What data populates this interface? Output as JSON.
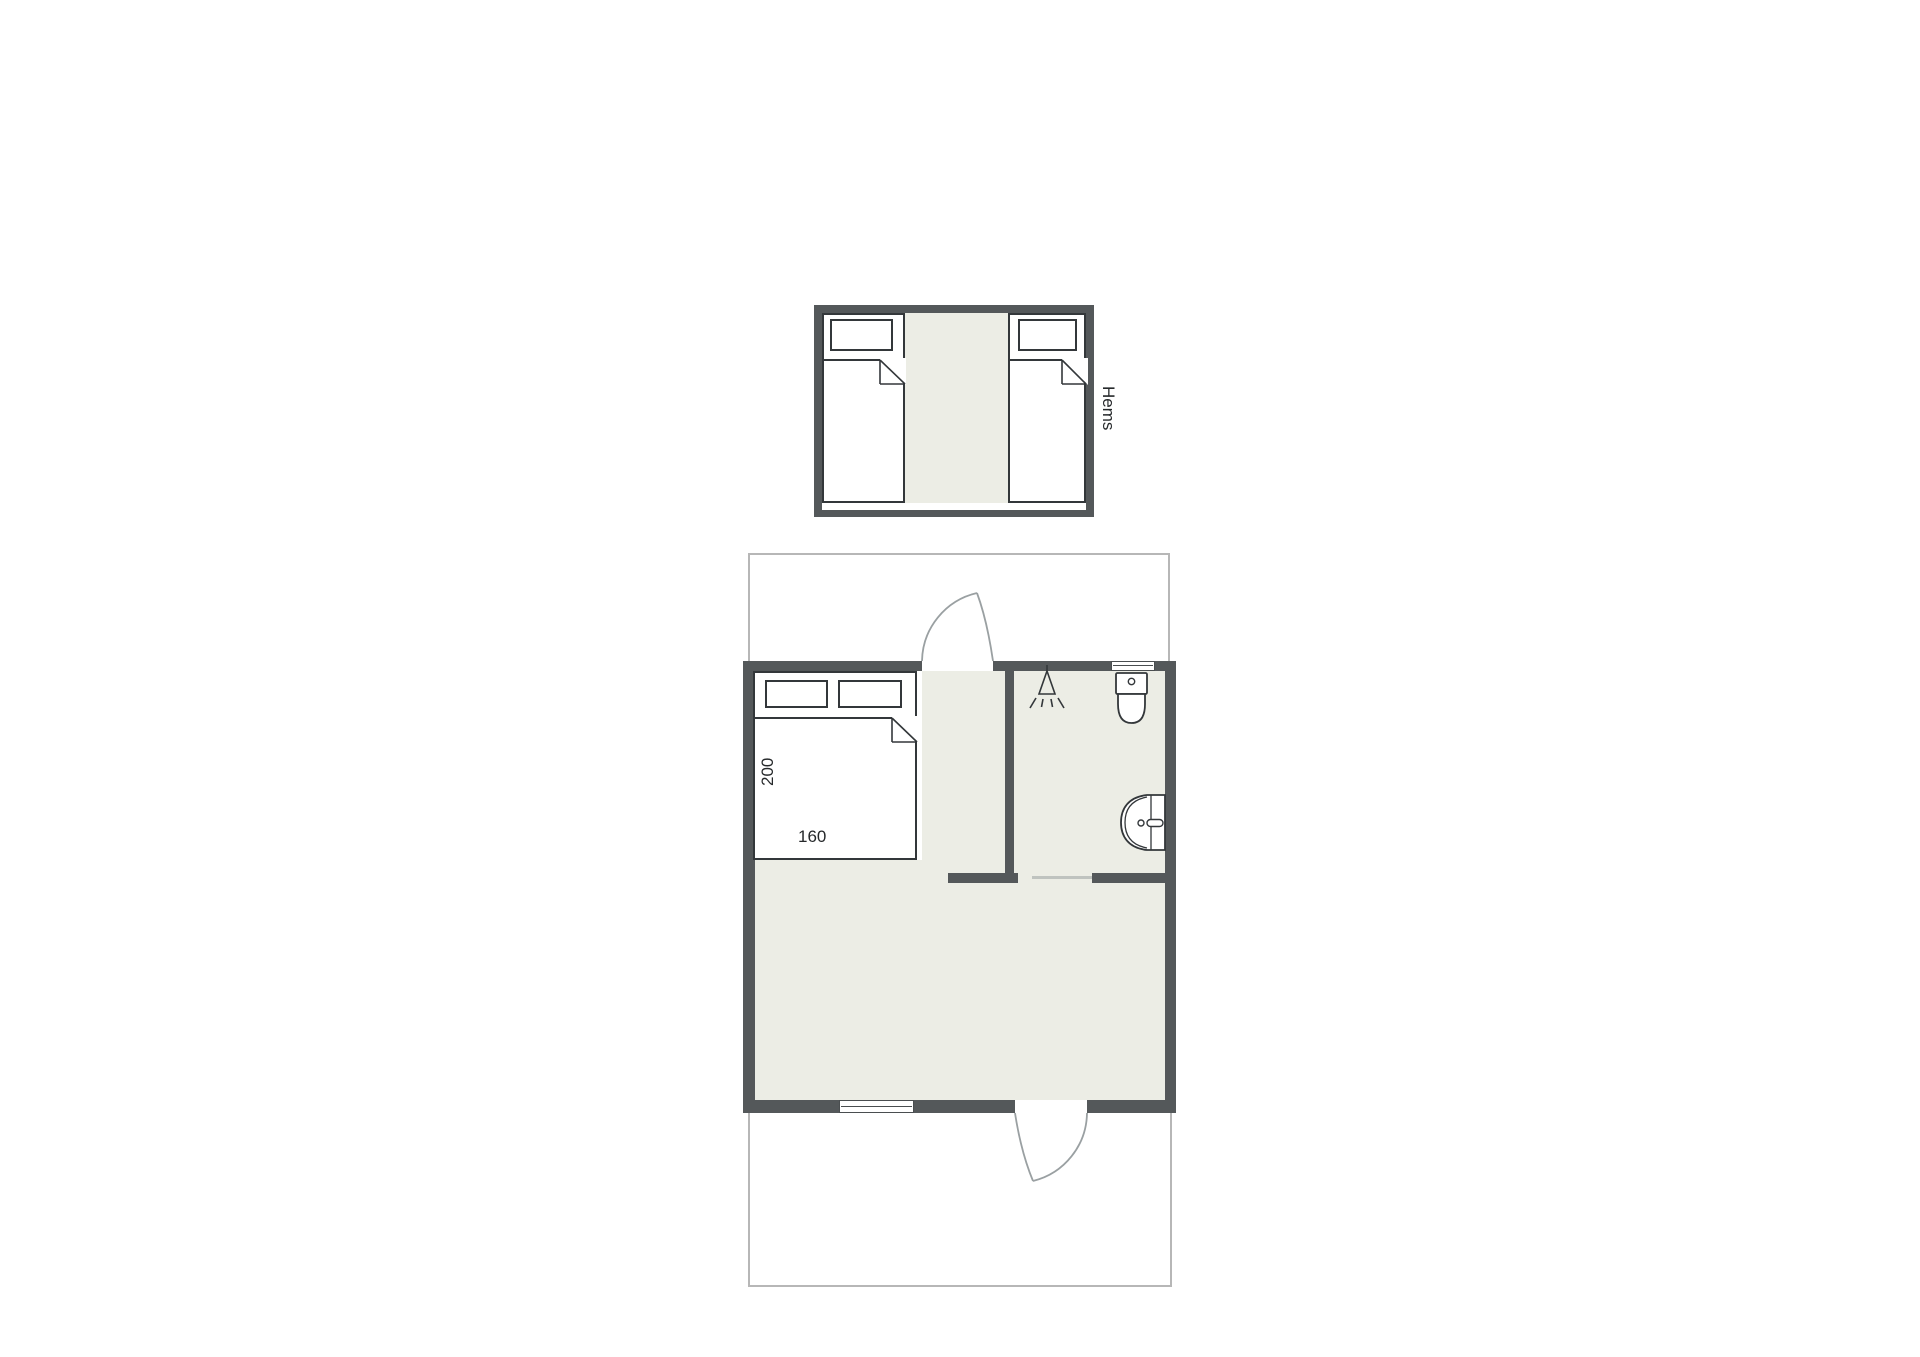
{
  "labels": {
    "loft": "Hems",
    "bed_length_cm": "200",
    "bed_width_cm": "160"
  },
  "colors": {
    "wall": "#54585a",
    "floor": "#ecede5",
    "outline": "#33373a",
    "deck_line": "#b7b7b7",
    "door_line": "#9aa0a2",
    "sliding_door_line": "#bfc3bf",
    "text": "#26292b",
    "background": "#ffffff"
  }
}
